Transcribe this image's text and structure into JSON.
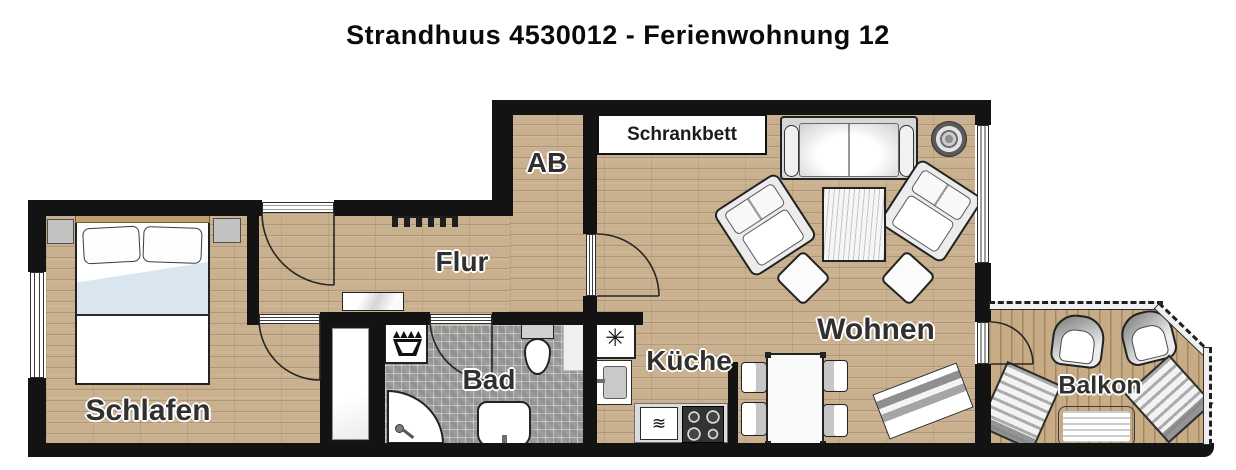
{
  "title": "Strandhuus 4530012 - Ferienwohnung 12",
  "rooms": {
    "schlafen": "Schlafen",
    "flur": "Flur",
    "ab": "AB",
    "bad": "Bad",
    "kueche": "Küche",
    "wohnen": "Wohnen",
    "balkon": "Balkon"
  },
  "annotations": {
    "schrankbett": "Schrankbett"
  },
  "symbols": {
    "freezer": "✳",
    "microwave": "≋"
  },
  "colors": {
    "wall": "#131313",
    "wood_floor": "#c9b08e",
    "tile_floor": "#9d9d9d",
    "balcony_deck": "#c7ac85",
    "background": "#ffffff",
    "blanket_blue": "#d9e6f0"
  }
}
